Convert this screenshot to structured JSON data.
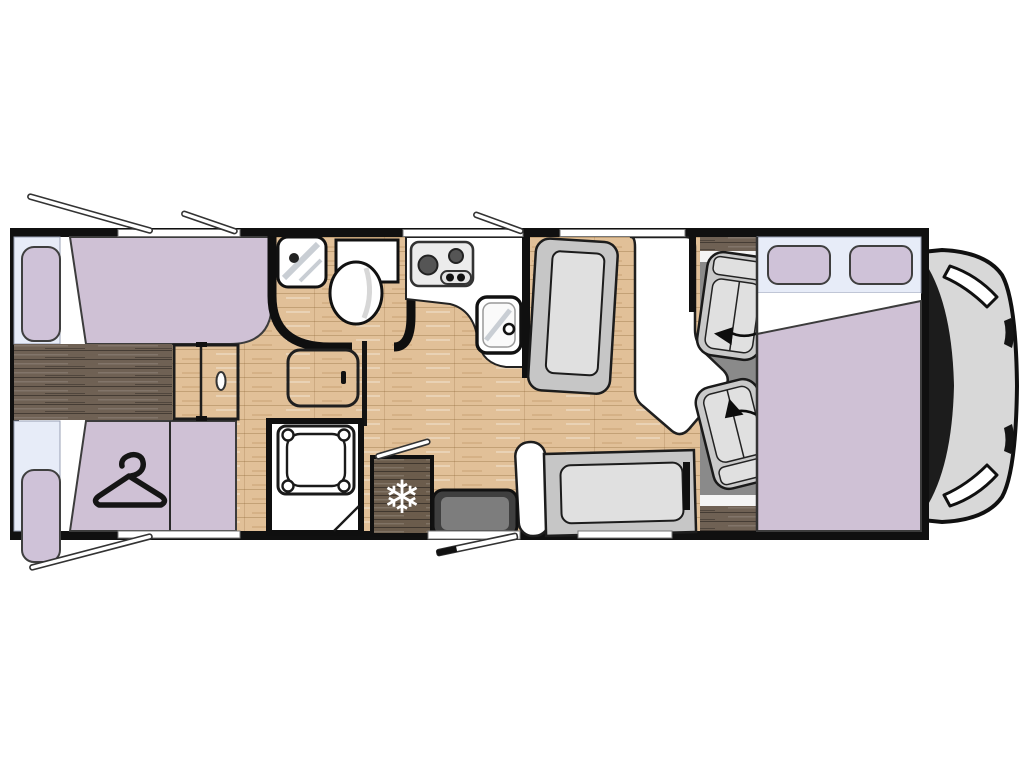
{
  "canvas": {
    "width": 1024,
    "height": 768,
    "background": "#ffffff"
  },
  "icons": {
    "fridge_snowflake": "❄",
    "wardrobe_hanger": "clothes-hanger-shape",
    "seat_swivel": "curved-rotation-arrow"
  },
  "colors": {
    "wall_black": "#101010",
    "bedding_purple": "#cfc1d5",
    "pillow_purple": "#cfc2d8",
    "window_blue": "#e7ecf8",
    "wood_light": "#e1c098",
    "wood_dark": "#6f6154",
    "cab_floor": "#8a8a8a",
    "seat_gray": "#c9c9c9",
    "cushion_gray": "#e0e0e0",
    "bench_gray": "#c6c6c6",
    "vehicle_gray": "#d8d8d8",
    "windshield_black": "#1c1c1c"
  },
  "components": {
    "vehicle": "motorhome-floorplan-top-view",
    "rear": [
      "twin-single-bed-top",
      "twin-single-bed-bottom",
      "center-step-chest",
      "wardrobe-with-hanger",
      "bedroom-sliding-door"
    ],
    "middle": [
      "bathroom-corner-sink",
      "toilet",
      "shower-tray",
      "corridor-cabinet",
      "refrigerator"
    ],
    "kitchen": [
      "two-burner-stove",
      "kitchen-sink",
      "worktop"
    ],
    "lounge": [
      "forward-facing-bench",
      "dinette-table",
      "rear-facing-bench",
      "entry-step",
      "entry-door"
    ],
    "cab": [
      "driver-swivel-seat",
      "passenger-swivel-seat",
      "drop-down-bed-with-pillows",
      "vehicle-front-hood",
      "windshield",
      "headlights"
    ]
  }
}
